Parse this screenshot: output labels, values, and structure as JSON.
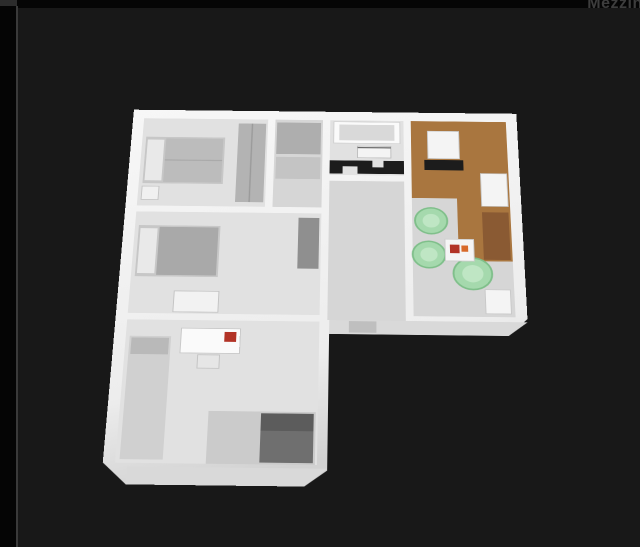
{
  "watermark": {
    "text": "Mezzino"
  },
  "viewer": {
    "type": "3d-floorplan-render",
    "description": "Isometric 3D dollhouse view of an L-shaped apartment floor plan on a dark viewer background"
  },
  "palette": {
    "bg_black": "#050505",
    "panel_dark": "#181818",
    "divider_gray": "#3a3a3a",
    "watermark_gray": "#3d3d3d",
    "slab_white": "#f7f7f7",
    "slab_shade": "#d2d2d2",
    "slab_face": "#d9d9d9",
    "floor_light": "#e1e1e1",
    "floor_mid": "#d6d6d6",
    "floor_dark": "#cbcbcb",
    "wood_floor": "#a9763f",
    "counter_black": "#1c1c1c",
    "chair_green": "#a5d9ad",
    "chair_green_rim": "#7fbf8a",
    "accent_red": "#b23326",
    "furniture_gray": "#b3b3b3",
    "furniture_dark_gray": "#8f8f8f",
    "bed_mattress": "#c7c7c7",
    "pillow_white": "#e9e9e9",
    "shower_gray": "#6f6f6f",
    "cabinet_white": "#f4f4f4",
    "bookcase_brown": "#8a5a33",
    "door_gray": "#bfbfbf"
  },
  "rooms": [
    {
      "name": "bedroom-top-left",
      "furniture": [
        "double-bed",
        "nightstand",
        "wardrobe"
      ]
    },
    {
      "name": "closet-nook",
      "furniture": [
        "closet-upper",
        "closet-lower"
      ]
    },
    {
      "name": "bathroom-top",
      "furniture": [
        "bathtub",
        "black-vanity-counter",
        "wall-cabinet"
      ]
    },
    {
      "name": "kitchen-right",
      "furniture": [
        "fridge-cabinet",
        "black-cooktop-counter",
        "wall-cabinets",
        "lower-cabinet"
      ]
    },
    {
      "name": "living-room",
      "furniture": [
        "green-armchair-1",
        "green-armchair-2",
        "green-armchair-3",
        "coffee-table",
        "red-table-decor",
        "bookcase"
      ]
    },
    {
      "name": "bedroom-middle-left",
      "furniture": [
        "double-bed",
        "tall-wardrobe",
        "dresser"
      ]
    },
    {
      "name": "bedroom-bottom-left",
      "furniture": [
        "single-bed",
        "desk",
        "red-desk-chair"
      ]
    },
    {
      "name": "bathroom-bottom",
      "furniture": [
        "shower-enclosure"
      ]
    },
    {
      "name": "corridor",
      "furniture": [
        "entrance-door"
      ]
    }
  ]
}
